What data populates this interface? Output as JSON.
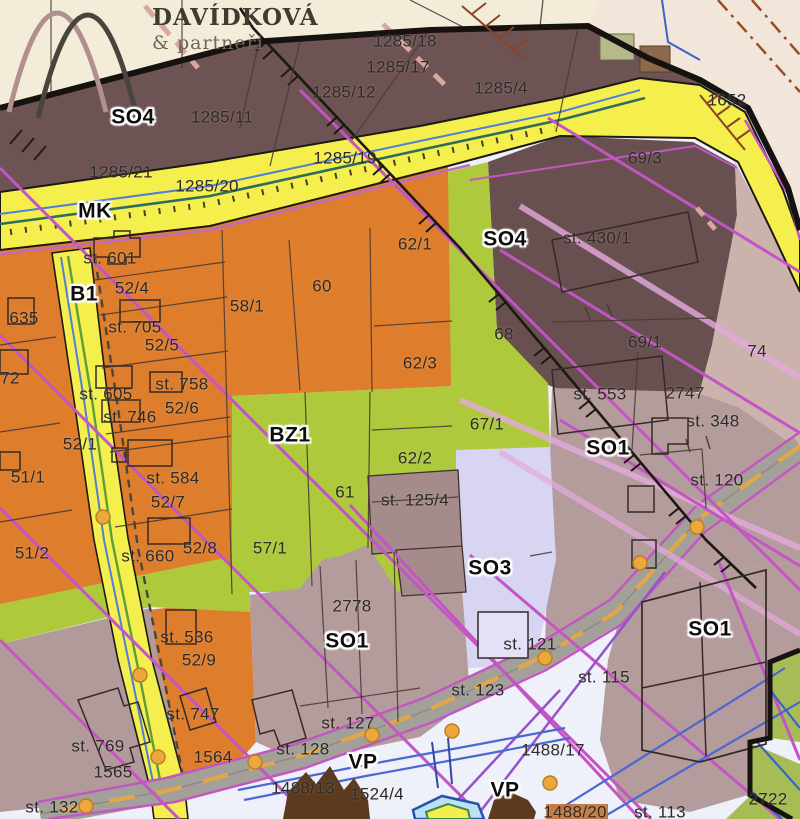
{
  "logo": {
    "title": "DAVÍDKOVÁ",
    "subtitle": "& partneři"
  },
  "map": {
    "legend_colors": {
      "residential_orange": "#de7e2d",
      "mixed_dark_brown_SO4": "#6d5353",
      "mixed_mauve_SO1": "#b49c9c",
      "green_BZ1": "#aeca3c",
      "lavender_SO3": "#d7d5f1",
      "road_yellow": "#f5ef4d",
      "zone_74_pink": "#cbb2ad",
      "utility_magenta": "#c455c4",
      "water_blue": "#4a68d0",
      "road_gray": "#a3a099",
      "boundary_black": "#151210"
    },
    "zone_labels": [
      {
        "text": "SO4",
        "x": 133,
        "y": 117
      },
      {
        "text": "MK",
        "x": 95,
        "y": 211
      },
      {
        "text": "B1",
        "x": 84,
        "y": 294
      },
      {
        "text": "SO4",
        "x": 505,
        "y": 239
      },
      {
        "text": "BZ1",
        "x": 290,
        "y": 435
      },
      {
        "text": "SO1",
        "x": 608,
        "y": 448
      },
      {
        "text": "SO1",
        "x": 347,
        "y": 641
      },
      {
        "text": "SO3",
        "x": 490,
        "y": 568
      },
      {
        "text": "SO1",
        "x": 710,
        "y": 629
      },
      {
        "text": "VP",
        "x": 363,
        "y": 762
      },
      {
        "text": "VP",
        "x": 505,
        "y": 790
      }
    ],
    "parcel_labels": [
      {
        "text": "1285/18",
        "x": 405,
        "y": 41
      },
      {
        "text": "1285/17",
        "x": 398,
        "y": 67
      },
      {
        "text": "1285/12",
        "x": 344,
        "y": 92
      },
      {
        "text": "1285/4",
        "x": 501,
        "y": 88
      },
      {
        "text": "1285/11",
        "x": 222,
        "y": 117
      },
      {
        "text": "1285/21",
        "x": 121,
        "y": 172
      },
      {
        "text": "1285/20",
        "x": 207,
        "y": 186
      },
      {
        "text": "1285/19",
        "x": 345,
        "y": 158
      },
      {
        "text": "1652",
        "x": 727,
        "y": 100
      },
      {
        "text": "69/3",
        "x": 645,
        "y": 158
      },
      {
        "text": "st. 430/1",
        "x": 597,
        "y": 238
      },
      {
        "text": "st. 601",
        "x": 110,
        "y": 258
      },
      {
        "text": "52/4",
        "x": 132,
        "y": 288
      },
      {
        "text": "635",
        "x": 24,
        "y": 318
      },
      {
        "text": "st. 705",
        "x": 135,
        "y": 327
      },
      {
        "text": "52/5",
        "x": 162,
        "y": 345
      },
      {
        "text": "72",
        "x": 10,
        "y": 378
      },
      {
        "text": "st. 605",
        "x": 106,
        "y": 394
      },
      {
        "text": "st. 758",
        "x": 182,
        "y": 384
      },
      {
        "text": "52/6",
        "x": 182,
        "y": 408
      },
      {
        "text": "st. 746",
        "x": 130,
        "y": 417
      },
      {
        "text": "58/1",
        "x": 247,
        "y": 306
      },
      {
        "text": "60",
        "x": 322,
        "y": 286
      },
      {
        "text": "62/1",
        "x": 415,
        "y": 244
      },
      {
        "text": "52/1",
        "x": 80,
        "y": 444
      },
      {
        "text": "51/1",
        "x": 28,
        "y": 477
      },
      {
        "text": "st. 584",
        "x": 173,
        "y": 478
      },
      {
        "text": "52/7",
        "x": 168,
        "y": 502
      },
      {
        "text": "51/2",
        "x": 32,
        "y": 553
      },
      {
        "text": "st. 660",
        "x": 148,
        "y": 556
      },
      {
        "text": "52/8",
        "x": 200,
        "y": 548
      },
      {
        "text": "57/1",
        "x": 270,
        "y": 548
      },
      {
        "text": "61",
        "x": 345,
        "y": 492
      },
      {
        "text": "62/2",
        "x": 415,
        "y": 458
      },
      {
        "text": "62/3",
        "x": 420,
        "y": 363
      },
      {
        "text": "67/1",
        "x": 487,
        "y": 424
      },
      {
        "text": "68",
        "x": 504,
        "y": 334
      },
      {
        "text": "st. 125/4",
        "x": 415,
        "y": 500
      },
      {
        "text": "st. 553",
        "x": 600,
        "y": 394
      },
      {
        "text": "2747",
        "x": 685,
        "y": 393
      },
      {
        "text": "st. 348",
        "x": 713,
        "y": 421
      },
      {
        "text": "st. 120",
        "x": 717,
        "y": 480
      },
      {
        "text": "69/1",
        "x": 645,
        "y": 342
      },
      {
        "text": "74",
        "x": 757,
        "y": 351
      },
      {
        "text": "2778",
        "x": 352,
        "y": 606
      },
      {
        "text": "st. 121",
        "x": 530,
        "y": 644
      },
      {
        "text": "st. 123",
        "x": 478,
        "y": 690
      },
      {
        "text": "st. 127",
        "x": 348,
        "y": 723
      },
      {
        "text": "st. 128",
        "x": 303,
        "y": 749
      },
      {
        "text": "1488/13",
        "x": 303,
        "y": 788
      },
      {
        "text": "1524/4",
        "x": 377,
        "y": 794
      },
      {
        "text": "1488/17",
        "x": 553,
        "y": 750
      },
      {
        "text": "st. 115",
        "x": 604,
        "y": 677
      },
      {
        "text": "1488/20",
        "x": 575,
        "y": 812
      },
      {
        "text": "st. 113",
        "x": 660,
        "y": 812
      },
      {
        "text": "2722",
        "x": 768,
        "y": 799
      },
      {
        "text": "st. 132",
        "x": 52,
        "y": 807
      },
      {
        "text": "st. 769",
        "x": 98,
        "y": 746
      },
      {
        "text": "1565",
        "x": 113,
        "y": 772
      },
      {
        "text": "st. 747",
        "x": 193,
        "y": 714
      },
      {
        "text": "1564",
        "x": 213,
        "y": 757
      },
      {
        "text": "st. 536",
        "x": 187,
        "y": 637
      },
      {
        "text": "52/9",
        "x": 199,
        "y": 660
      }
    ]
  }
}
